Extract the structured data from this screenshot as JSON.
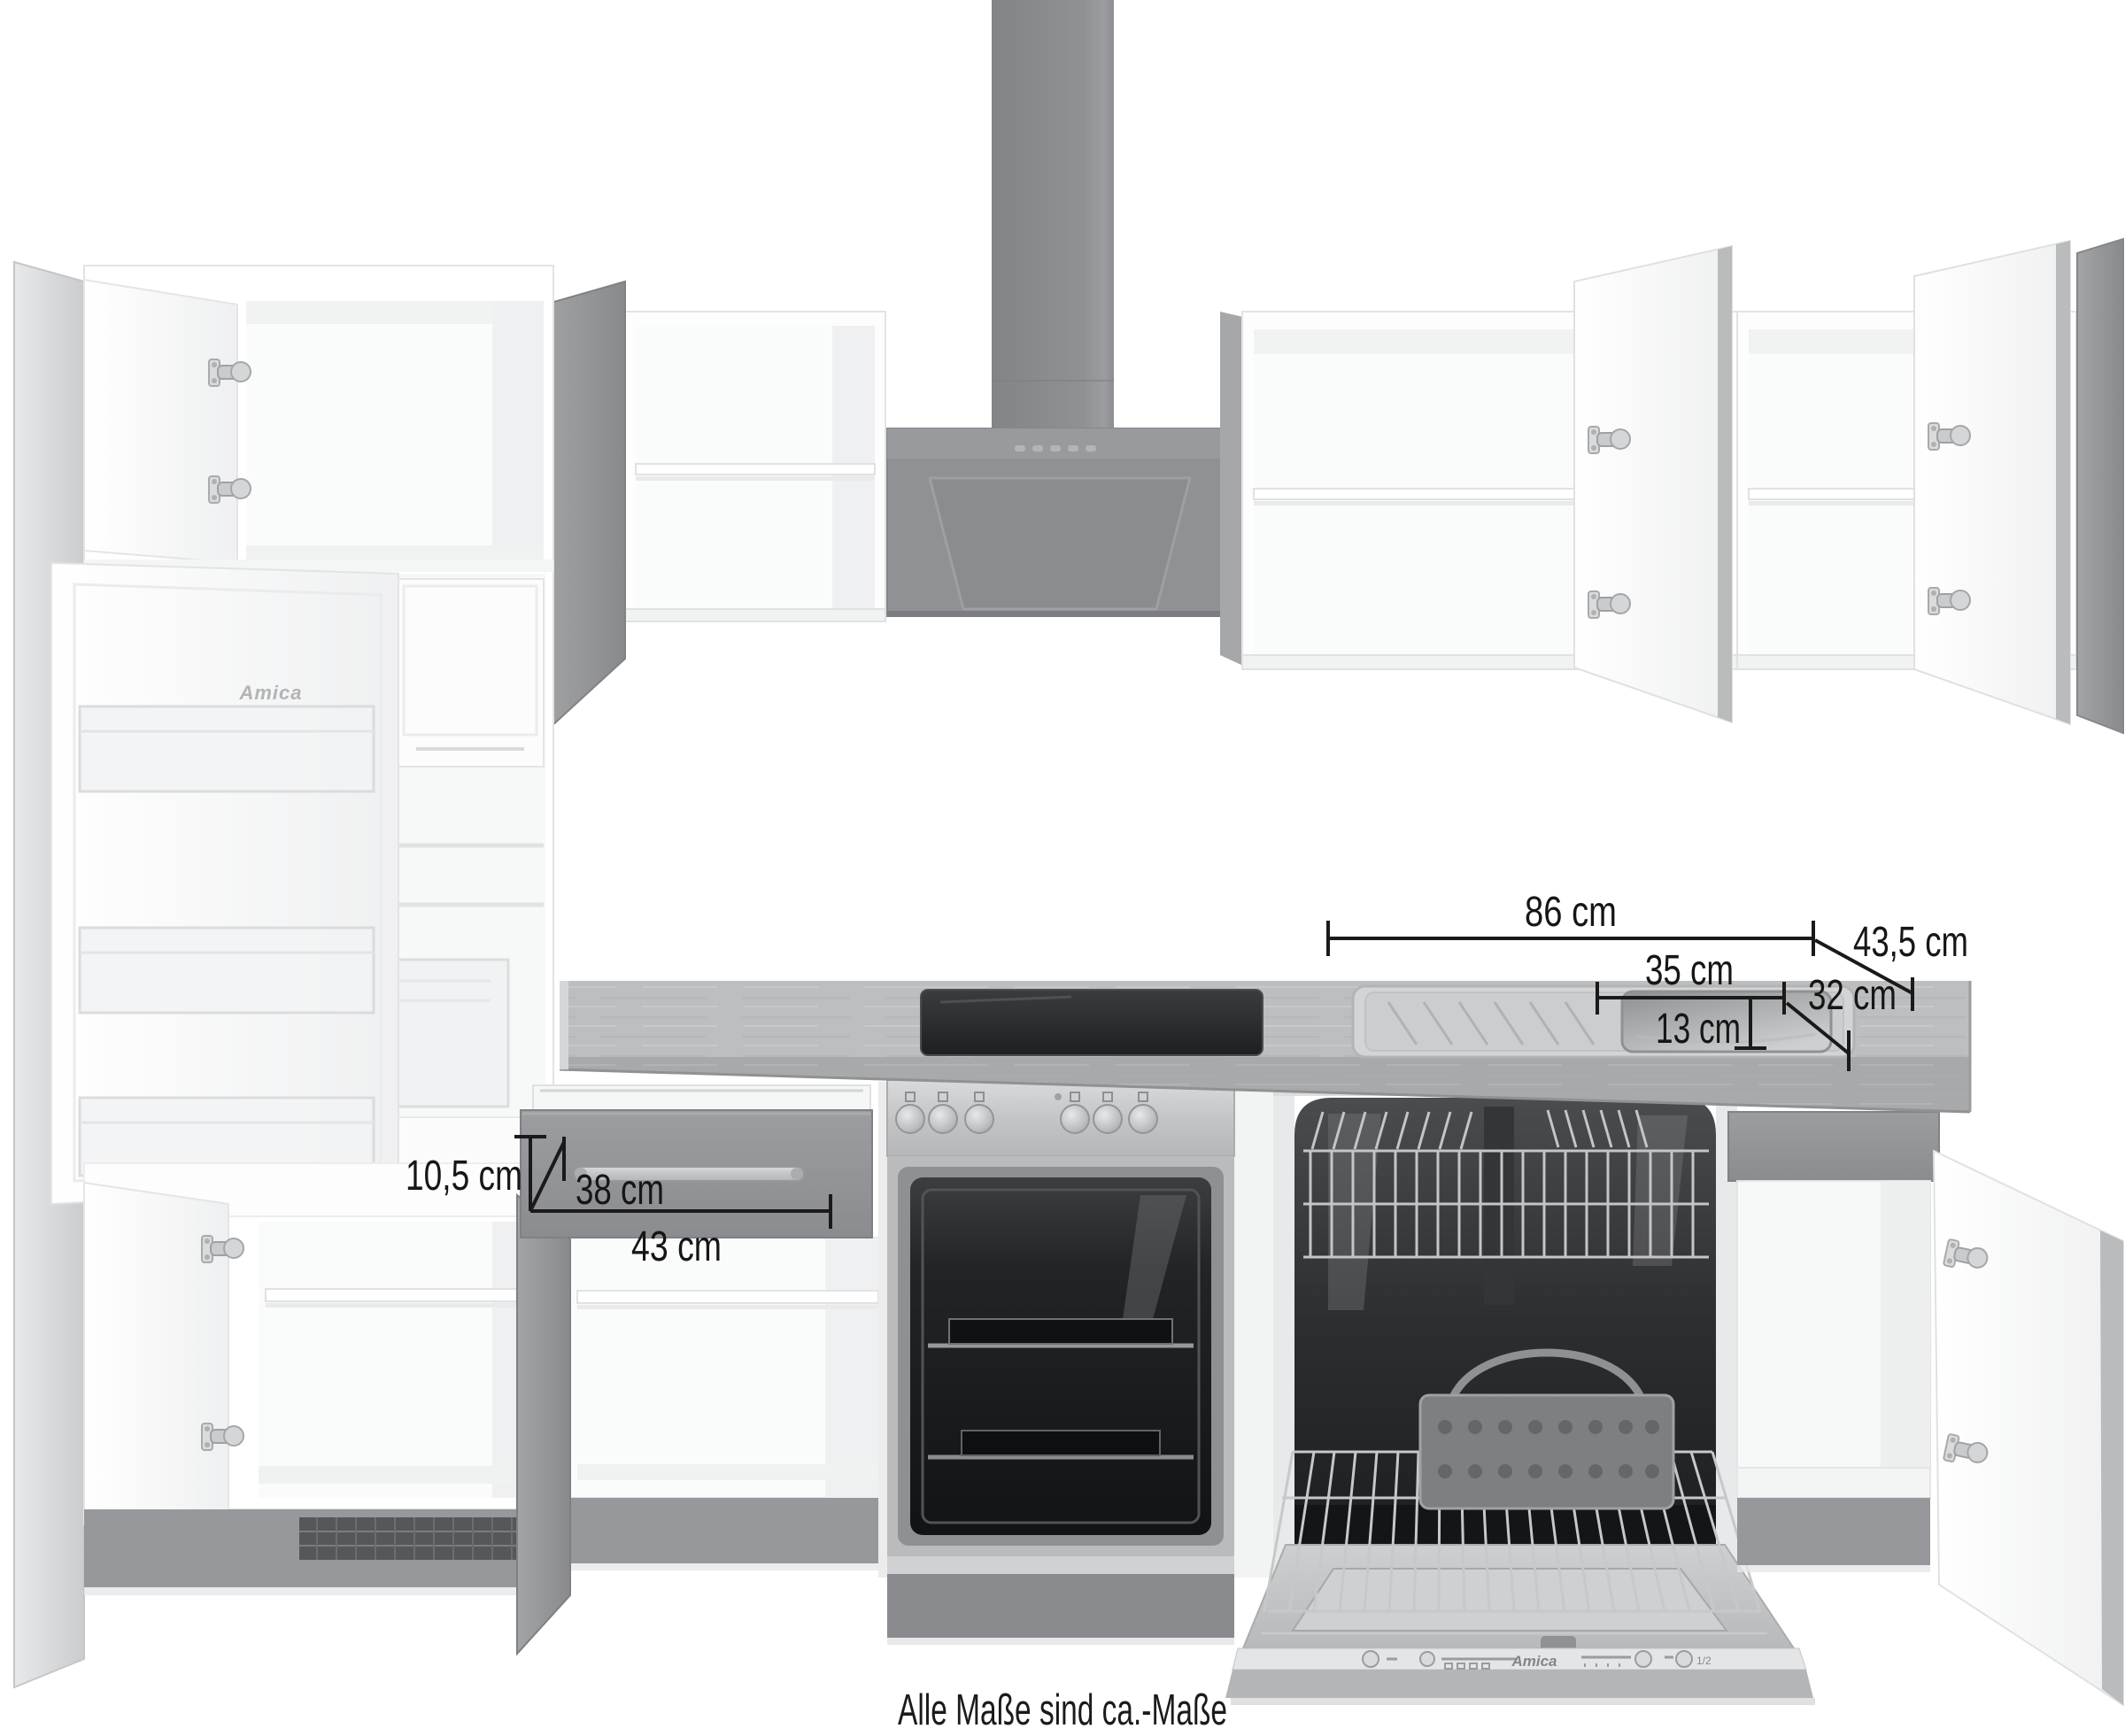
{
  "caption": "Alle Maße sind ca.-Maße",
  "annotations": {
    "worktop_width": "86 cm",
    "worktop_depth": "43,5 cm",
    "basin_width": "35 cm",
    "basin_inner_depth": "13 cm",
    "basin_depth": "32 cm",
    "drawer_front_height": "10,5 cm",
    "handle_width": "38 cm",
    "drawer_front_width": "43 cm"
  },
  "branding": {
    "fridge_logo": "Amica",
    "dishwasher_logo": "Amica"
  },
  "dishwasher_panel": {
    "half_load_label": "1/2"
  },
  "colors": {
    "front_gray": "#939598",
    "hood_gray": "#8f9194",
    "carcass_white": "#ffffff",
    "worktop_wood": "#bcbec0",
    "stainless": "#c9cbcd",
    "oven_cavity": "#1a1b1d",
    "annotation_black": "#1a1a1a"
  }
}
